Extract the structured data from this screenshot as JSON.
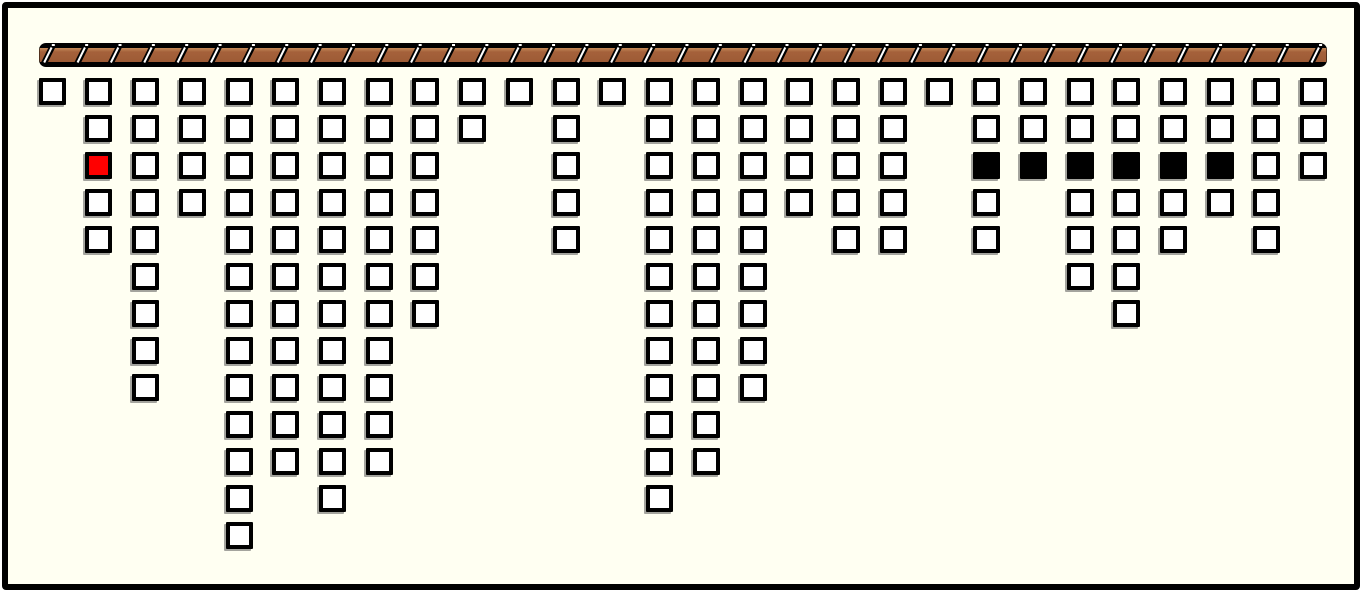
{
  "board": {
    "background": "#FFFFF2",
    "frame_color": "#000000",
    "block_count": 167
  },
  "bar": {
    "segment_count": 39,
    "wood_color": "#A5613B",
    "wood_highlight": "#C58A58",
    "wood_shadow": "#9D5B35",
    "outline_color": "#000000",
    "separator_color": "#FFFFFF"
  },
  "cell_colors": {
    "white": "#FFFFFF",
    "red": "#FF0000",
    "black": "#000000"
  },
  "grid": {
    "column_count": 28,
    "max_rows": 13,
    "columns": [
      {
        "height": 1,
        "special_cells": []
      },
      {
        "height": 5,
        "special_cells": [
          {
            "row": 3,
            "color": "red"
          }
        ]
      },
      {
        "height": 9,
        "special_cells": []
      },
      {
        "height": 4,
        "special_cells": []
      },
      {
        "height": 13,
        "special_cells": []
      },
      {
        "height": 11,
        "special_cells": []
      },
      {
        "height": 12,
        "special_cells": []
      },
      {
        "height": 11,
        "special_cells": []
      },
      {
        "height": 7,
        "special_cells": []
      },
      {
        "height": 2,
        "special_cells": []
      },
      {
        "height": 1,
        "special_cells": []
      },
      {
        "height": 5,
        "special_cells": []
      },
      {
        "height": 1,
        "special_cells": []
      },
      {
        "height": 12,
        "special_cells": []
      },
      {
        "height": 11,
        "special_cells": []
      },
      {
        "height": 9,
        "special_cells": []
      },
      {
        "height": 4,
        "special_cells": []
      },
      {
        "height": 5,
        "special_cells": []
      },
      {
        "height": 5,
        "special_cells": []
      },
      {
        "height": 1,
        "special_cells": []
      },
      {
        "height": 5,
        "special_cells": [
          {
            "row": 3,
            "color": "black"
          }
        ]
      },
      {
        "height": 3,
        "special_cells": [
          {
            "row": 3,
            "color": "black"
          }
        ]
      },
      {
        "height": 6,
        "special_cells": [
          {
            "row": 3,
            "color": "black"
          }
        ]
      },
      {
        "height": 7,
        "special_cells": [
          {
            "row": 3,
            "color": "black"
          }
        ]
      },
      {
        "height": 5,
        "special_cells": [
          {
            "row": 3,
            "color": "black"
          }
        ]
      },
      {
        "height": 4,
        "special_cells": [
          {
            "row": 3,
            "color": "black"
          }
        ]
      },
      {
        "height": 5,
        "special_cells": []
      },
      {
        "height": 3,
        "special_cells": []
      }
    ]
  }
}
